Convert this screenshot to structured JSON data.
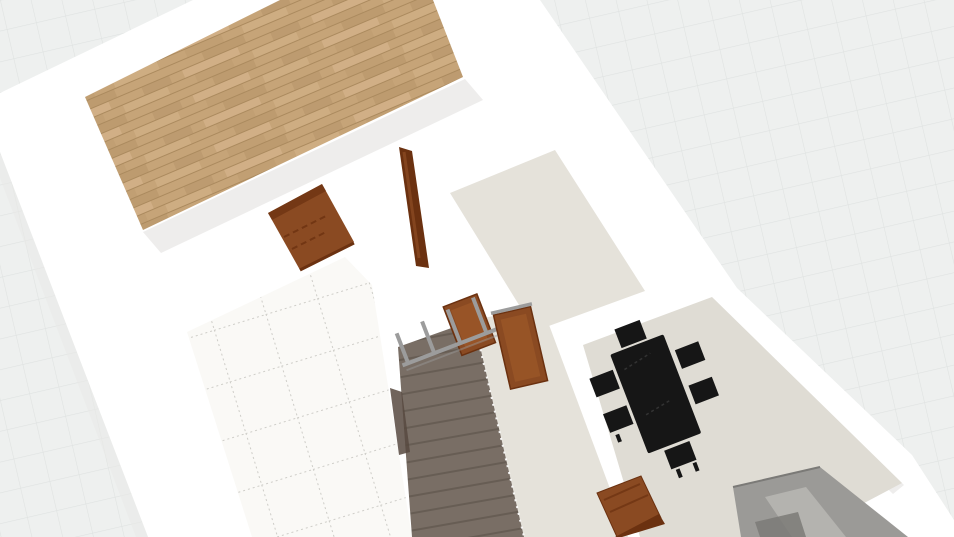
{
  "scene": {
    "description": "3D bird's-eye floor plan view",
    "colors": {
      "background": "#eef0ef",
      "grid_line": "#dfe2e1",
      "wall": "#ffffff",
      "wall_shade": "#eae9e7",
      "wood_floor": "#c6a478",
      "wood_floor_dark": "#ab8a5e",
      "wood_floor_light": "#d3b289",
      "tile_floor": "#faf9f6",
      "tile_grout": "#b7b5b0",
      "concrete_floor": "#e5e2da",
      "dining_floor": "#dfdcd4",
      "stairs": "#796e65",
      "stairs_step": "#675d54",
      "stairs_side": "#57493f",
      "door_wood": "#8a4a22",
      "door_wood_dark": "#6b3110",
      "door_wood_light": "#9a5628",
      "railing_metal": "#9c9c9c",
      "table_black": "#161616",
      "sofa_gray": "#9b9a97",
      "sofa_gray_light": "#b4b3af",
      "sofa_gray_dark": "#7b7a77"
    },
    "objects": [
      {
        "name": "background-grid",
        "kind": "ground plane grid"
      },
      {
        "name": "exterior-walls",
        "kind": "white building walls"
      },
      {
        "name": "wood-floor-room",
        "kind": "room with wood plank floor"
      },
      {
        "name": "tile-floor-room",
        "kind": "room with white tile floor"
      },
      {
        "name": "upper-room-floor",
        "kind": "room with concrete floor"
      },
      {
        "name": "hallway-floor",
        "kind": "hallway with concrete floor"
      },
      {
        "name": "dining-room-floor",
        "kind": "dining room floor"
      },
      {
        "name": "staircase",
        "kind": "descending stairs"
      },
      {
        "name": "stair-railing",
        "kind": "metal railing with wood panels"
      },
      {
        "name": "interior-door-open",
        "kind": "open wooden door"
      },
      {
        "name": "interior-door-edge",
        "kind": "wooden door seen edge-on"
      },
      {
        "name": "interior-door-lower",
        "kind": "wooden door lower wall"
      },
      {
        "name": "dining-table",
        "kind": "black dining table"
      },
      {
        "name": "dining-chair",
        "kind": "black dining chair"
      },
      {
        "name": "sofa",
        "kind": "gray sofa"
      }
    ]
  }
}
